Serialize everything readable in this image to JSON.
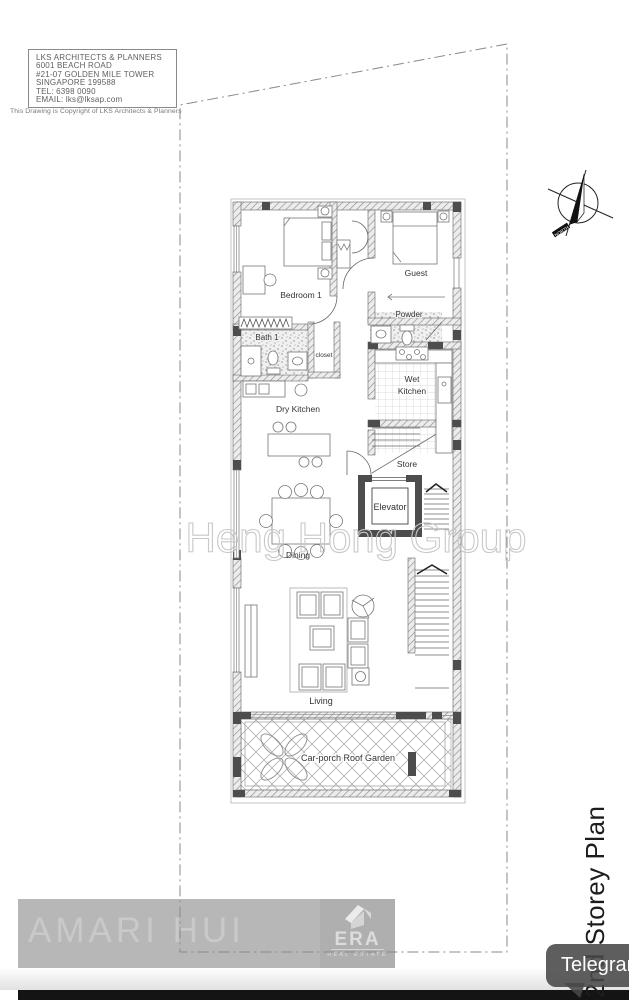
{
  "title_block": {
    "name": "LKS ARCHITECTS & PLANNERS",
    "address1": "6001 BEACH ROAD",
    "address2": "#21-07 GOLDEN MILE TOWER",
    "address3": "SINGAPORE 199588",
    "tel": "TEL: 6398 0090",
    "email": "EMAIL: lks@lksap.com",
    "copyright": "This Drawing is Copyright of LKS Architects & Planners"
  },
  "compass": {
    "label": "NORTH"
  },
  "plan": {
    "labels": {
      "bedroom1": "Bedroom 1",
      "guest": "Guest",
      "powder": "Powder",
      "bath1": "Bath 1",
      "closet": "closet",
      "wet_l1": "Wet",
      "wet_l2": "Kitchen",
      "dry_kitchen": "Dry Kitchen",
      "store": "Store",
      "elevator": "Elevator",
      "dining": "Dining",
      "living": "Living",
      "carporch": "Car-porch Roof Garden"
    },
    "storey_label": "2nd Storey Plan"
  },
  "watermarks": {
    "group": "Heng Hong Group",
    "agent": "AMARI HUI"
  },
  "era": {
    "brand": "ERA",
    "tagline": "REAL ESTATE"
  },
  "telegram": {
    "label": "Telegram"
  },
  "colors": {
    "wall_dark": "#4d4d4d",
    "band_gray": "#b7b7b7",
    "button_gray": "rgba(72,72,72,0.88)",
    "bottom_bar": "#141414"
  }
}
